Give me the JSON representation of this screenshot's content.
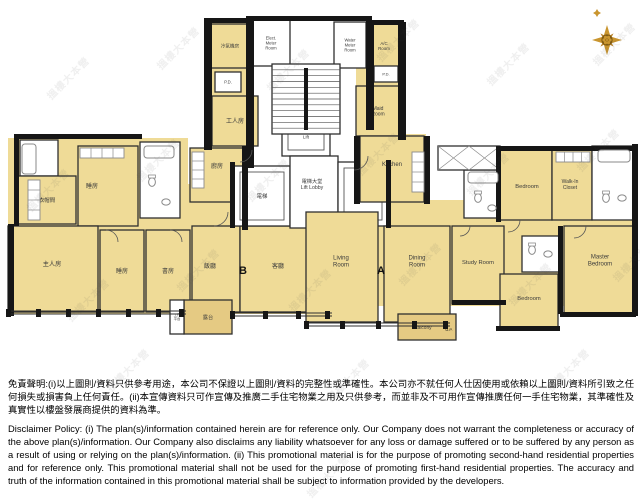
{
  "page": {
    "background": "#ffffff"
  },
  "compass": {
    "cx": 607,
    "cy": 40,
    "gold": "#C9952F",
    "gold2": "#B8832B",
    "dark": "#7F5A12"
  },
  "watermark": {
    "text": "搵樓大本營",
    "positions": [
      [
        40,
        70
      ],
      [
        150,
        40
      ],
      [
        260,
        62
      ],
      [
        370,
        32
      ],
      [
        480,
        56
      ],
      [
        586,
        36
      ],
      [
        20,
        182
      ],
      [
        130,
        152
      ],
      [
        240,
        172
      ],
      [
        350,
        146
      ],
      [
        460,
        166
      ],
      [
        570,
        142
      ],
      [
        60,
        292
      ],
      [
        170,
        262
      ],
      [
        282,
        282
      ],
      [
        392,
        256
      ],
      [
        502,
        276
      ],
      [
        606,
        252
      ],
      [
        100,
        362
      ],
      [
        320,
        372
      ],
      [
        540,
        362
      ],
      [
        300,
        468
      ]
    ]
  },
  "plan": {
    "colors": {
      "room": "#EFDB97",
      "balcony": "#E5CA83",
      "white": "#ffffff",
      "wall": "#161616",
      "stroke": "#2f2f2f",
      "fixture": "#8a8a8a",
      "label": "#3b3b3b",
      "line": "#555555"
    },
    "underlays": [
      [
        8,
        138,
        180,
        176
      ],
      [
        206,
        22,
        48,
        182
      ],
      [
        184,
        184,
        150,
        130
      ],
      [
        356,
        22,
        46,
        116
      ],
      [
        356,
        134,
        70,
        70
      ],
      [
        306,
        200,
        330,
        106
      ],
      [
        498,
        146,
        138,
        76
      ]
    ],
    "rooms": [
      {
        "id": "ac-plant-b",
        "label": "冷氣機房",
        "x": 210,
        "y": 24,
        "w": 40,
        "h": 44,
        "f": "room",
        "fs": 4.6
      },
      {
        "id": "pd-b",
        "label": "P.D.",
        "x": 215,
        "y": 72,
        "w": 26,
        "h": 20,
        "f": "white",
        "fs": 4.2
      },
      {
        "id": "maid-room-b",
        "label": "工人房",
        "x": 212,
        "y": 96,
        "w": 46,
        "h": 50,
        "f": "room",
        "fs": 6
      },
      {
        "id": "kitchen-b",
        "label": "廚房",
        "x": 190,
        "y": 148,
        "w": 54,
        "h": 54,
        "f": "room",
        "fs": 6,
        "ly": 168
      },
      {
        "id": "bath-b1",
        "label": "",
        "x": 20,
        "y": 140,
        "w": 38,
        "h": 36,
        "f": "white"
      },
      {
        "id": "cloakroom-b",
        "label": "衣帽間",
        "x": 18,
        "y": 176,
        "w": 58,
        "h": 48,
        "f": "room",
        "fs": 5.4,
        "ly": 202
      },
      {
        "id": "bedroom-b1",
        "label": "睡房",
        "x": 78,
        "y": 146,
        "w": 60,
        "h": 80,
        "f": "room",
        "fs": 6,
        "lx": 92,
        "ly": 188
      },
      {
        "id": "bath-b2",
        "label": "",
        "x": 140,
        "y": 142,
        "w": 40,
        "h": 76,
        "f": "white"
      },
      {
        "id": "master-bedroom-b",
        "label": "主人房",
        "x": 8,
        "y": 226,
        "w": 90,
        "h": 86,
        "f": "room",
        "fs": 6.2,
        "lx": 52,
        "ly": 266
      },
      {
        "id": "bedroom-b2",
        "label": "睡房",
        "x": 100,
        "y": 230,
        "w": 44,
        "h": 82,
        "f": "room",
        "fs": 6
      },
      {
        "id": "study-b",
        "label": "書房",
        "x": 146,
        "y": 230,
        "w": 44,
        "h": 82,
        "f": "room",
        "fs": 6
      },
      {
        "id": "dining-b",
        "label": "飯廳",
        "x": 192,
        "y": 226,
        "w": 48,
        "h": 86,
        "f": "room",
        "fs": 6,
        "lx": 210,
        "ly": 268
      },
      {
        "id": "living-b",
        "label": "客廳",
        "x": 240,
        "y": 226,
        "w": 92,
        "h": 86,
        "f": "room",
        "fs": 6,
        "lx": 278,
        "ly": 268
      },
      {
        "id": "balcony-b",
        "label": "露台",
        "x": 184,
        "y": 300,
        "w": 48,
        "h": 34,
        "f": "balcony",
        "fs": 5.2
      },
      {
        "id": "utility-platform-b",
        "label": "工作\n平台",
        "x": 170,
        "y": 300,
        "w": 14,
        "h": 34,
        "f": "white",
        "fs": 3.4
      },
      {
        "id": "elect-meter-room",
        "label": "Elect.\nMeter\nRoom",
        "x": 252,
        "y": 20,
        "w": 38,
        "h": 46,
        "f": "white",
        "fs": 4.2
      },
      {
        "id": "water-meter-room",
        "label": "Water\nMeter\nRoom",
        "x": 334,
        "y": 22,
        "w": 32,
        "h": 46,
        "f": "white",
        "fs": 4.2
      },
      {
        "id": "lift-top",
        "label": "Lift",
        "x": 282,
        "y": 118,
        "w": 48,
        "h": 38,
        "f": "white",
        "fs": 4.6,
        "lift": true
      },
      {
        "id": "lift-b",
        "label": "電梯",
        "x": 234,
        "y": 166,
        "w": 56,
        "h": 60,
        "f": "white",
        "fs": 5.4,
        "lift": true
      },
      {
        "id": "lift-lobby",
        "label": "電梯大堂\nLift Lobby",
        "x": 290,
        "y": 156,
        "w": 48,
        "h": 72,
        "f": "white",
        "fs": 5.2,
        "lx": 312,
        "ly": 186
      },
      {
        "id": "lift-a",
        "label": "Lift",
        "x": 338,
        "y": 162,
        "w": 50,
        "h": 64,
        "f": "white",
        "fs": 5,
        "lift": true
      },
      {
        "id": "ac-room-a",
        "label": "A/C\nRoom",
        "x": 368,
        "y": 24,
        "w": 32,
        "h": 44,
        "f": "room",
        "fs": 4.4
      },
      {
        "id": "pd-a",
        "label": "P.D.",
        "x": 374,
        "y": 66,
        "w": 24,
        "h": 16,
        "f": "white",
        "fs": 4
      },
      {
        "id": "maid-room-a",
        "label": "Maid\nRoom",
        "x": 356,
        "y": 86,
        "w": 44,
        "h": 50,
        "f": "room",
        "fs": 5
      },
      {
        "id": "kitchen-a",
        "label": "Kitchen",
        "x": 360,
        "y": 136,
        "w": 64,
        "h": 66,
        "f": "room",
        "fs": 6,
        "ly": 166
      },
      {
        "id": "bath-a1",
        "label": "",
        "x": 464,
        "y": 170,
        "w": 38,
        "h": 48,
        "f": "white"
      },
      {
        "id": "bedroom-a1",
        "label": "Bedroom",
        "x": 500,
        "y": 150,
        "w": 52,
        "h": 70,
        "f": "room",
        "fs": 5.8,
        "lx": 527,
        "ly": 188
      },
      {
        "id": "walk-in-closet-a",
        "label": "Walk-In\nCloset",
        "x": 552,
        "y": 150,
        "w": 40,
        "h": 70,
        "f": "room",
        "fs": 5,
        "lx": 570,
        "ly": 186
      },
      {
        "id": "bath-a2",
        "label": "",
        "x": 592,
        "y": 146,
        "w": 42,
        "h": 74,
        "f": "white"
      },
      {
        "id": "living-room-a",
        "label": "Living\nRoom",
        "x": 306,
        "y": 212,
        "w": 72,
        "h": 110,
        "f": "room",
        "fs": 6,
        "lx": 341,
        "ly": 263
      },
      {
        "id": "dining-room-a",
        "label": "Dining\nRoom",
        "x": 384,
        "y": 226,
        "w": 66,
        "h": 96,
        "f": "room",
        "fs": 6,
        "lx": 417,
        "ly": 263
      },
      {
        "id": "study-room-a",
        "label": "Study Room",
        "x": 452,
        "y": 226,
        "w": 52,
        "h": 78,
        "f": "room",
        "fs": 5.8,
        "ly": 264
      },
      {
        "id": "bath-a3",
        "label": "",
        "x": 522,
        "y": 236,
        "w": 38,
        "h": 36,
        "f": "white"
      },
      {
        "id": "bedroom-a2",
        "label": "Bedroom",
        "x": 500,
        "y": 274,
        "w": 58,
        "h": 54,
        "f": "room",
        "fs": 5.8,
        "ly": 300
      },
      {
        "id": "master-bedroom-a",
        "label": "Master\nBedroom",
        "x": 564,
        "y": 226,
        "w": 70,
        "h": 88,
        "f": "room",
        "fs": 6,
        "lx": 600,
        "ly": 262
      },
      {
        "id": "balcony-a",
        "label": "Balcony",
        "x": 398,
        "y": 314,
        "w": 58,
        "h": 26,
        "f": "balcony",
        "fs": 4.8,
        "lx": 423,
        "ly": 329
      },
      {
        "id": "flat-roof-a",
        "label": "",
        "x": 438,
        "y": 146,
        "w": 62,
        "h": 24,
        "f": "white",
        "hatch": true
      }
    ],
    "unit_labels": [
      {
        "text": "B",
        "x": 243,
        "y": 274,
        "fs": 11,
        "bold": true
      },
      {
        "text": "A",
        "x": 381,
        "y": 274,
        "fs": 11,
        "bold": true
      },
      {
        "text": "U.P.",
        "x": 449,
        "y": 331,
        "fs": 4,
        "bold": false
      }
    ],
    "walls": [
      [
        204,
        18,
        8,
        132
      ],
      [
        204,
        18,
        50,
        5
      ],
      [
        246,
        16,
        8,
        152
      ],
      [
        246,
        16,
        126,
        5
      ],
      [
        366,
        20,
        8,
        110
      ],
      [
        366,
        20,
        38,
        5
      ],
      [
        398,
        22,
        8,
        118
      ],
      [
        14,
        134,
        128,
        5
      ],
      [
        14,
        138,
        5,
        88
      ],
      [
        8,
        224,
        6,
        92
      ],
      [
        632,
        144,
        6,
        172
      ],
      [
        500,
        146,
        136,
        5
      ],
      [
        424,
        136,
        6,
        68
      ],
      [
        354,
        136,
        6,
        68
      ],
      [
        242,
        146,
        6,
        84
      ],
      [
        452,
        300,
        54,
        5
      ],
      [
        496,
        326,
        64,
        5
      ],
      [
        560,
        312,
        76,
        5
      ],
      [
        230,
        162,
        5,
        66
      ],
      [
        386,
        160,
        5,
        68
      ],
      [
        496,
        146,
        5,
        76
      ],
      [
        558,
        226,
        5,
        88
      ]
    ],
    "windows": [
      {
        "y": 311,
        "x1": 8,
        "x2": 186,
        "posts": [
          8,
          38,
          68,
          98,
          128,
          158,
          181
        ]
      },
      {
        "y": 313,
        "x1": 232,
        "x2": 332,
        "posts": [
          232,
          265,
          298,
          327
        ]
      },
      {
        "y": 323,
        "x1": 306,
        "x2": 450,
        "posts": [
          306,
          342,
          378,
          414,
          445
        ]
      }
    ],
    "stairs": {
      "x": 272,
      "y": 64,
      "w": 68,
      "h": 70,
      "treads": 12
    },
    "doors": [
      "M106,230 A12,12 0 0 1 118,242",
      "M170,230 A12,12 0 0 1 182,242",
      "M214,226 A14,14 0 0 0 228,212",
      "M520,220 A12,12 0 0 1 508,232",
      "M586,226 A12,12 0 0 1 574,238",
      "M470,226 A10,10 0 0 1 460,236",
      "M368,156 A14,14 0 0 1 354,170",
      "M252,150 A12,12 0 0 1 240,162"
    ],
    "tubs": [
      [
        22,
        144,
        14,
        30
      ],
      [
        144,
        146,
        30,
        12
      ],
      [
        468,
        172,
        30,
        11
      ],
      [
        598,
        150,
        32,
        12
      ]
    ],
    "wcs": [
      [
        152,
        182
      ],
      [
        478,
        198
      ],
      [
        606,
        198
      ],
      [
        532,
        250
      ]
    ],
    "sinks": [
      [
        166,
        202
      ],
      [
        492,
        208
      ],
      [
        622,
        198
      ],
      [
        548,
        254
      ]
    ],
    "counters": [
      [
        28,
        180,
        12,
        40
      ],
      [
        80,
        148,
        44,
        10
      ],
      [
        192,
        152,
        12,
        36
      ],
      [
        412,
        152,
        12,
        40
      ],
      [
        556,
        152,
        34,
        10
      ]
    ]
  },
  "disclaimer": {
    "zh": "免責聲明:(i)以上圖則/資料只供參考用途，本公司不保證以上圖則/資料的完整性或準確性。本公司亦不就任何人仕因使用或依賴以上圖則/資料所引致之任何損失或損害負上任何責任。(ii)本宣傳資料只可作宣傳及推廣二手住宅物業之用及只供參考，而並非及不可用作宣傳推廣任何一手住宅物業，其準確性及真實性以樓盤發展商提供的資料為準。",
    "en": "Disclaimer Policy: (i) The plan(s)/information contained herein are for reference only. Our Company does not warrant the completeness or accuracy of the above plan(s)/information. Our Company also disclaims any liability whatsoever for any loss or damage suffered or to be suffered by any person as a result of using or relying on the plan(s)/information. (ii) This promotional material is for the purpose of promoting second-hand residential properties and for reference only. This promotional material shall not be used for the purpose of promoting first-hand residential properties. The accuracy and truth of the information contained in this promotional material shall be subject to information provided by the developers."
  }
}
